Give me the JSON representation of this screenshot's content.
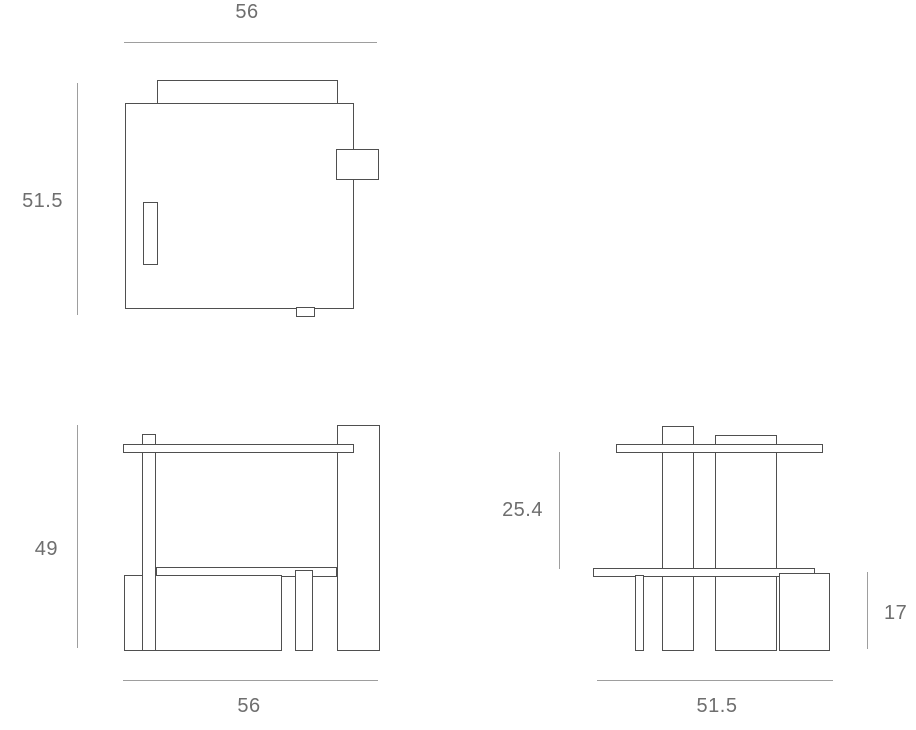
{
  "colors": {
    "stroke": "#4f4f4f",
    "dim_line": "#9e9e9e",
    "label_text": "#6e6e6e",
    "background": "#ffffff"
  },
  "views": {
    "top": {
      "width": "56",
      "depth": "51.5"
    },
    "front": {
      "height": "49",
      "width": "56"
    },
    "side": {
      "upper_height": "25.4",
      "box_height": "17",
      "depth": "51.5"
    }
  }
}
